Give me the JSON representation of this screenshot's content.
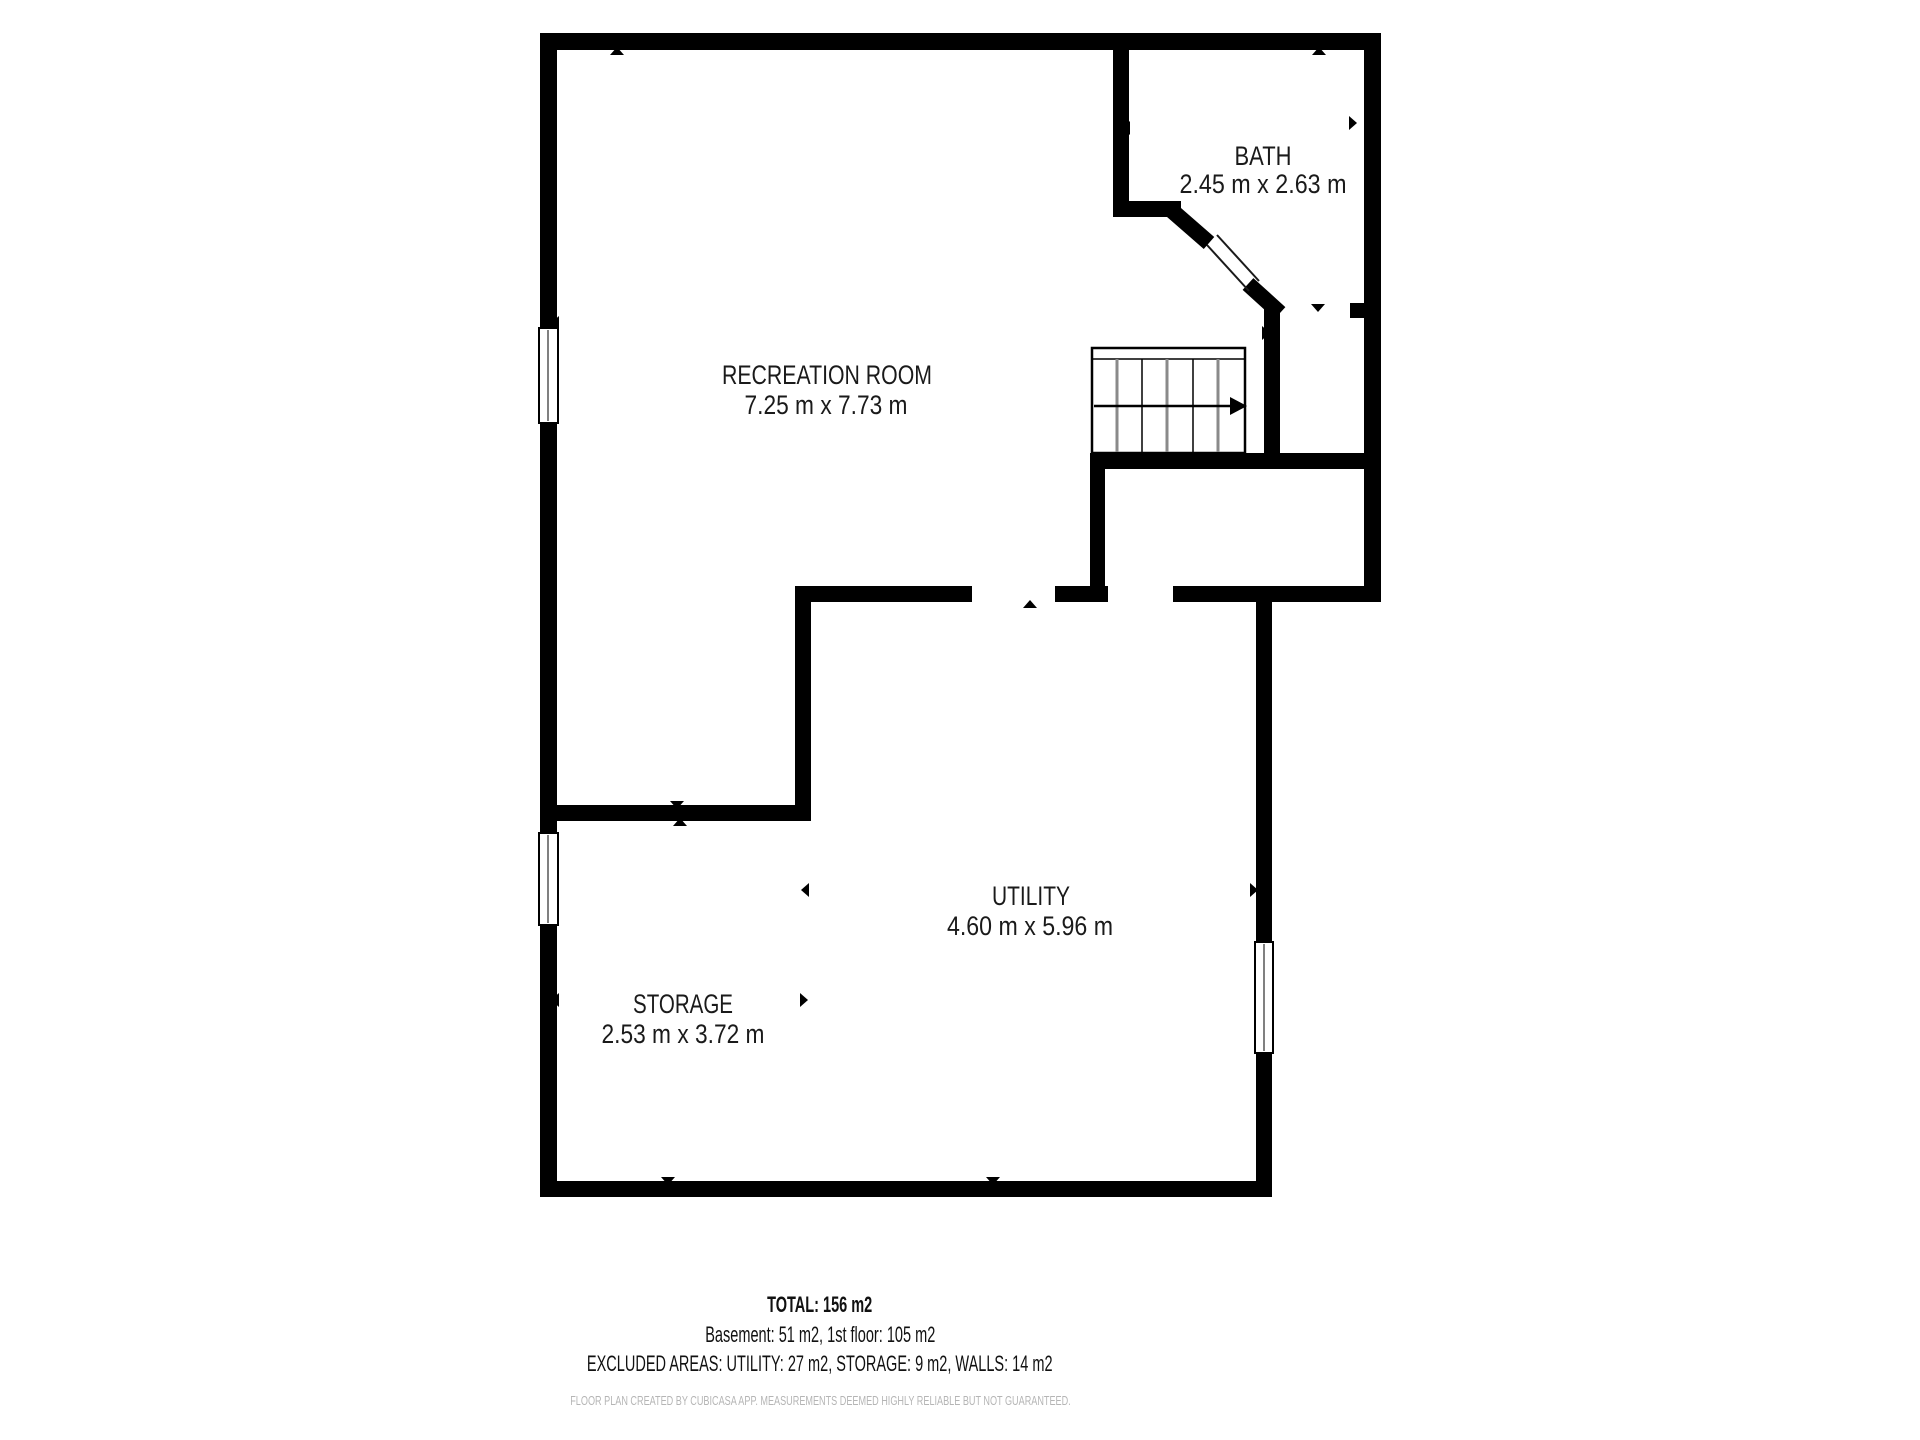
{
  "page": {
    "background": "#ffffff",
    "type_label": "basement floor plan"
  },
  "floorplan": {
    "rooms": [
      {
        "name": "RECREATION ROOM",
        "dimensions": "7.25 m x 7.73 m"
      },
      {
        "name": "BATH",
        "dimensions": "2.45 m x 2.63 m"
      },
      {
        "name": "UTILITY",
        "dimensions": "4.60 m x 5.96 m"
      },
      {
        "name": "STORAGE",
        "dimensions": "2.53 m x 3.72 m"
      }
    ],
    "colors": {
      "wall": "#000000",
      "step_line_gray": "#8a8a8a",
      "room_text": "#1a1a1a",
      "disclaimer_text": "#b5b5b5"
    }
  },
  "summary": {
    "total": "TOTAL: 156 m2",
    "floors": "Basement: 51 m2, 1st floor: 105 m2",
    "excluded_areas": "EXCLUDED AREAS: UTILITY: 27 m2, STORAGE: 9 m2, WALLS: 14 m2",
    "disclaimer": "FLOOR PLAN CREATED BY CUBICASA APP. MEASUREMENTS DEEMED HIGHLY RELIABLE BUT NOT GUARANTEED."
  }
}
